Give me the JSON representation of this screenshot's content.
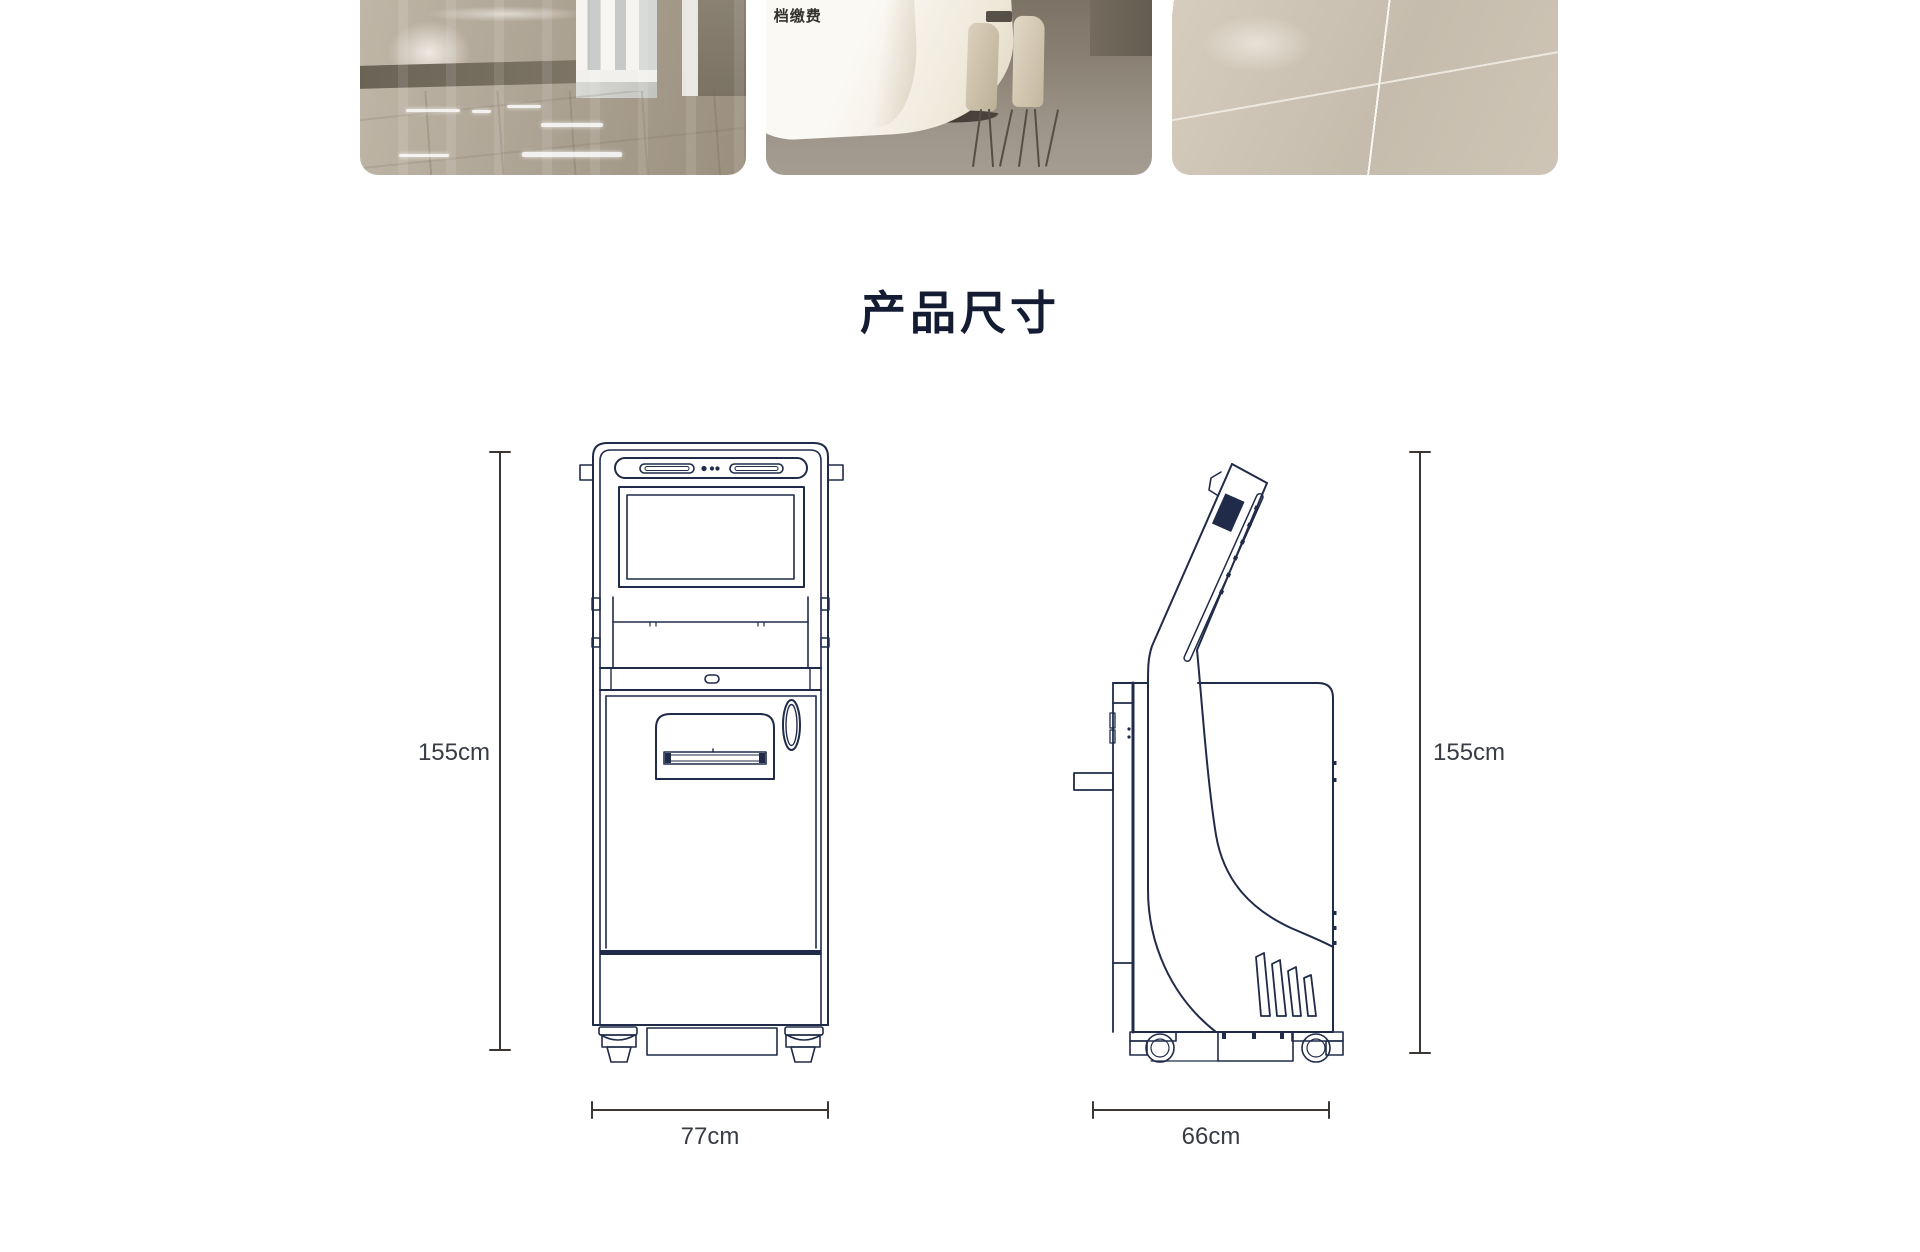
{
  "title": "产品尺寸",
  "gallery": {
    "photos": [
      {
        "id": "lobby-hallway"
      },
      {
        "id": "reception-desk",
        "visible_text": "档缴费"
      },
      {
        "id": "tile-floor"
      }
    ]
  },
  "front_view": {
    "height_label": "155cm",
    "width_label": "77cm"
  },
  "side_view": {
    "height_label": "155cm",
    "width_label": "66cm"
  },
  "colors": {
    "title_text": "#141c33",
    "drawing_line": "#1f2b49",
    "dimension_line": "#3c3733",
    "dimension_text": "#383c44"
  }
}
